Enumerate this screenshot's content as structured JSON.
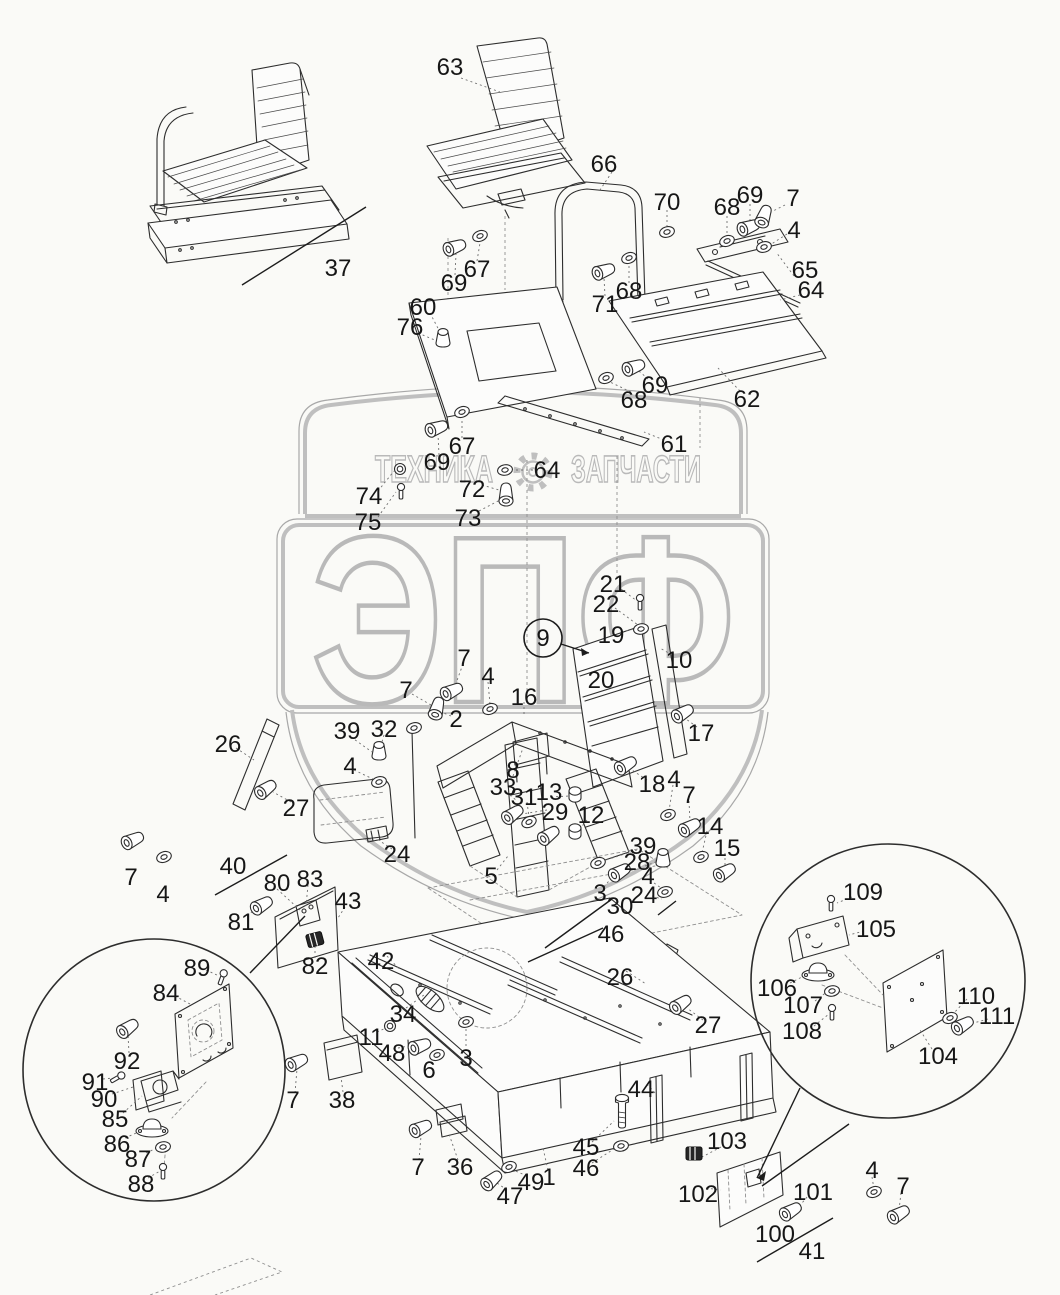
{
  "watermark": {
    "left": "ТЕХНИКА",
    "right": "ЗАПЧАСТИ",
    "big": "ЭПФ",
    "color": "#bfbfbf"
  },
  "colors": {
    "bg": "#fafaf7",
    "ink": "#2d2d2d",
    "label": "#161616",
    "watermark": "#bfbfbf"
  },
  "circled": {
    "t": "9",
    "x": 543,
    "y": 638,
    "r": 19,
    "sx": 561,
    "sy": 644,
    "ex": 589,
    "ey": 653
  },
  "labels": [
    [
      "63",
      450,
      67
    ],
    [
      "37",
      338,
      268
    ],
    [
      "66",
      604,
      164
    ],
    [
      "70",
      667,
      202
    ],
    [
      "68",
      727,
      207
    ],
    [
      "69",
      750,
      195
    ],
    [
      "7",
      793,
      198
    ],
    [
      "4",
      794,
      230
    ],
    [
      "65",
      805,
      270
    ],
    [
      "64",
      811,
      290
    ],
    [
      "71",
      605,
      304
    ],
    [
      "68",
      629,
      291
    ],
    [
      "60",
      423,
      307
    ],
    [
      "76",
      410,
      327
    ],
    [
      "67",
      477,
      269
    ],
    [
      "69",
      454,
      283
    ],
    [
      "69",
      655,
      385
    ],
    [
      "68",
      634,
      400
    ],
    [
      "62",
      747,
      399
    ],
    [
      "61",
      674,
      444
    ],
    [
      "67",
      462,
      446
    ],
    [
      "69",
      437,
      462
    ],
    [
      "64",
      547,
      470
    ],
    [
      "72",
      472,
      489
    ],
    [
      "73",
      468,
      518
    ],
    [
      "74",
      369,
      496
    ],
    [
      "75",
      368,
      522
    ],
    [
      "21",
      613,
      584
    ],
    [
      "22",
      606,
      604
    ],
    [
      "19",
      611,
      635
    ],
    [
      "10",
      679,
      660
    ],
    [
      "20",
      601,
      680
    ],
    [
      "7",
      464,
      658
    ],
    [
      "4",
      488,
      676
    ],
    [
      "7",
      406,
      690
    ],
    [
      "2",
      456,
      719
    ],
    [
      "16",
      524,
      697
    ],
    [
      "17",
      701,
      733
    ],
    [
      "26",
      228,
      744
    ],
    [
      "39",
      347,
      731
    ],
    [
      "32",
      384,
      729
    ],
    [
      "4",
      350,
      766
    ],
    [
      "27",
      296,
      808
    ],
    [
      "24",
      397,
      854
    ],
    [
      "8",
      513,
      770
    ],
    [
      "33",
      503,
      787
    ],
    [
      "31",
      524,
      797
    ],
    [
      "13",
      549,
      792
    ],
    [
      "29",
      555,
      812
    ],
    [
      "12",
      591,
      815
    ],
    [
      "18",
      652,
      784
    ],
    [
      "4",
      674,
      779
    ],
    [
      "7",
      689,
      795
    ],
    [
      "14",
      710,
      826
    ],
    [
      "15",
      727,
      848
    ],
    [
      "39",
      643,
      846
    ],
    [
      "28",
      637,
      862
    ],
    [
      "4",
      648,
      876
    ],
    [
      "24",
      644,
      895
    ],
    [
      "3",
      600,
      893
    ],
    [
      "30",
      620,
      906
    ],
    [
      "46",
      611,
      934
    ],
    [
      "5",
      491,
      876
    ],
    [
      "7",
      131,
      877
    ],
    [
      "4",
      163,
      894
    ],
    [
      "40",
      233,
      866
    ],
    [
      "80",
      277,
      883
    ],
    [
      "83",
      310,
      879
    ],
    [
      "81",
      241,
      922
    ],
    [
      "43",
      348,
      901
    ],
    [
      "82",
      315,
      966
    ],
    [
      "89",
      197,
      968
    ],
    [
      "84",
      166,
      993
    ],
    [
      "92",
      127,
      1061
    ],
    [
      "91",
      95,
      1082
    ],
    [
      "90",
      104,
      1099
    ],
    [
      "85",
      115,
      1119
    ],
    [
      "86",
      117,
      1144
    ],
    [
      "87",
      138,
      1159
    ],
    [
      "88",
      141,
      1184
    ],
    [
      "42",
      381,
      961
    ],
    [
      "34",
      403,
      1014
    ],
    [
      "11",
      371,
      1037
    ],
    [
      "48",
      392,
      1053
    ],
    [
      "6",
      429,
      1070
    ],
    [
      "3",
      466,
      1058
    ],
    [
      "7",
      293,
      1100
    ],
    [
      "38",
      342,
      1100
    ],
    [
      "7",
      418,
      1167
    ],
    [
      "36",
      460,
      1167
    ],
    [
      "47",
      510,
      1196
    ],
    [
      "49",
      531,
      1182
    ],
    [
      "1",
      549,
      1177
    ],
    [
      "45",
      586,
      1147
    ],
    [
      "46",
      586,
      1168
    ],
    [
      "44",
      641,
      1089
    ],
    [
      "26",
      620,
      977
    ],
    [
      "27",
      708,
      1025
    ],
    [
      "103",
      727,
      1141
    ],
    [
      "102",
      698,
      1194
    ],
    [
      "101",
      813,
      1192
    ],
    [
      "100",
      775,
      1234
    ],
    [
      "41",
      812,
      1251
    ],
    [
      "4",
      872,
      1170
    ],
    [
      "7",
      903,
      1186
    ],
    [
      "109",
      863,
      892
    ],
    [
      "105",
      876,
      929
    ],
    [
      "106",
      777,
      988
    ],
    [
      "107",
      803,
      1005
    ],
    [
      "108",
      802,
      1031
    ],
    [
      "104",
      938,
      1056
    ],
    [
      "110",
      976,
      996
    ],
    [
      "111",
      997,
      1016
    ]
  ],
  "leaders": {
    "solid": [
      [
        366,
        207,
        242,
        285
      ],
      [
        215,
        895,
        287,
        855
      ],
      [
        757,
        1262,
        833,
        1218
      ],
      [
        612,
        899,
        545,
        948
      ],
      [
        603,
        928,
        528,
        962
      ],
      [
        305,
        916,
        250,
        973
      ],
      [
        800,
        1088,
        757,
        1178
      ],
      [
        849,
        1124,
        762,
        1186
      ],
      [
        658,
        915,
        676,
        901
      ]
    ],
    "dotted": [
      [
        461,
        78,
        500,
        92
      ],
      [
        612,
        172,
        600,
        190
      ],
      [
        667,
        210,
        667,
        226
      ],
      [
        727,
        216,
        727,
        235
      ],
      [
        750,
        204,
        750,
        221
      ],
      [
        785,
        205,
        769,
        213
      ],
      [
        787,
        234,
        770,
        245
      ],
      [
        794,
        276,
        776,
        252
      ],
      [
        800,
        295,
        780,
        300
      ],
      [
        605,
        296,
        604,
        278
      ],
      [
        629,
        283,
        629,
        264
      ],
      [
        430,
        313,
        441,
        334
      ],
      [
        418,
        333,
        437,
        341
      ],
      [
        477,
        261,
        480,
        243
      ],
      [
        455,
        275,
        456,
        254
      ],
      [
        648,
        379,
        639,
        371
      ],
      [
        631,
        392,
        610,
        382
      ],
      [
        740,
        391,
        718,
        368
      ],
      [
        664,
        440,
        644,
        432
      ],
      [
        462,
        438,
        462,
        418
      ],
      [
        439,
        455,
        438,
        434
      ],
      [
        538,
        470,
        513,
        470
      ],
      [
        482,
        485,
        499,
        490
      ],
      [
        479,
        511,
        500,
        500
      ],
      [
        378,
        491,
        394,
        471
      ],
      [
        378,
        517,
        396,
        492
      ],
      [
        621,
        589,
        637,
        601
      ],
      [
        615,
        608,
        638,
        625
      ],
      [
        621,
        632,
        634,
        629
      ],
      [
        672,
        655,
        660,
        648
      ],
      [
        697,
        727,
        686,
        719
      ],
      [
        524,
        702,
        524,
        714
      ],
      [
        463,
        664,
        455,
        686
      ],
      [
        488,
        682,
        490,
        704
      ],
      [
        412,
        694,
        431,
        705
      ],
      [
        451,
        716,
        441,
        712
      ],
      [
        647,
        780,
        632,
        770
      ],
      [
        673,
        785,
        669,
        811
      ],
      [
        689,
        801,
        690,
        822
      ],
      [
        707,
        831,
        702,
        853
      ],
      [
        725,
        853,
        725,
        867
      ],
      [
        637,
        850,
        603,
        861
      ],
      [
        645,
        866,
        658,
        861
      ],
      [
        650,
        880,
        661,
        888
      ],
      [
        652,
        896,
        662,
        899
      ],
      [
        604,
        887,
        617,
        871
      ],
      [
        497,
        870,
        508,
        856
      ],
      [
        513,
        776,
        523,
        748
      ],
      [
        506,
        792,
        516,
        800
      ],
      [
        527,
        802,
        529,
        817
      ],
      [
        551,
        797,
        570,
        796
      ],
      [
        547,
        810,
        522,
        814
      ],
      [
        587,
        820,
        578,
        831
      ],
      [
        236,
        748,
        254,
        760
      ],
      [
        351,
        737,
        372,
        752
      ],
      [
        384,
        735,
        380,
        749
      ],
      [
        354,
        770,
        375,
        780
      ],
      [
        291,
        802,
        273,
        792
      ],
      [
        392,
        849,
        377,
        839
      ],
      [
        277,
        889,
        300,
        910
      ],
      [
        308,
        885,
        306,
        906
      ],
      [
        247,
        916,
        258,
        907
      ],
      [
        345,
        907,
        338,
        918
      ],
      [
        315,
        958,
        315,
        947
      ],
      [
        206,
        970,
        219,
        976
      ],
      [
        175,
        996,
        190,
        1004
      ],
      [
        129,
        1053,
        128,
        1035
      ],
      [
        103,
        1079,
        113,
        1078
      ],
      [
        112,
        1094,
        133,
        1087
      ],
      [
        123,
        1113,
        142,
        1096
      ],
      [
        125,
        1138,
        143,
        1130
      ],
      [
        146,
        1153,
        159,
        1147
      ],
      [
        148,
        1178,
        160,
        1171
      ],
      [
        387,
        956,
        400,
        970
      ],
      [
        406,
        1008,
        424,
        995
      ],
      [
        377,
        1032,
        388,
        1027
      ],
      [
        398,
        1048,
        414,
        1045
      ],
      [
        431,
        1064,
        436,
        1057
      ],
      [
        466,
        1051,
        466,
        1028
      ],
      [
        295,
        1093,
        297,
        1069
      ],
      [
        343,
        1092,
        341,
        1077
      ],
      [
        419,
        1160,
        421,
        1136
      ],
      [
        458,
        1160,
        449,
        1134
      ],
      [
        507,
        1190,
        497,
        1183
      ],
      [
        527,
        1176,
        511,
        1169
      ],
      [
        548,
        1170,
        543,
        1148
      ],
      [
        592,
        1142,
        614,
        1121
      ],
      [
        592,
        1163,
        617,
        1147
      ],
      [
        647,
        1084,
        655,
        1093
      ],
      [
        626,
        971,
        646,
        984
      ],
      [
        703,
        1020,
        687,
        1008
      ],
      [
        721,
        1147,
        702,
        1157
      ],
      [
        706,
        1188,
        721,
        1190
      ],
      [
        807,
        1197,
        797,
        1209
      ],
      [
        872,
        1177,
        874,
        1189
      ],
      [
        901,
        1193,
        899,
        1210
      ],
      [
        852,
        897,
        837,
        903
      ],
      [
        864,
        931,
        849,
        935
      ],
      [
        790,
        983,
        806,
        975
      ],
      [
        815,
        1001,
        828,
        991
      ],
      [
        814,
        1026,
        829,
        1014
      ],
      [
        932,
        1049,
        920,
        1030
      ],
      [
        967,
        999,
        953,
        1014
      ],
      [
        988,
        1019,
        970,
        1024
      ]
    ]
  },
  "hardware": [
    [
      "bolt",
      455,
      247,
      -20
    ],
    [
      "washer",
      480,
      236,
      -20
    ],
    [
      "bolt",
      604,
      271,
      -20
    ],
    [
      "washer",
      629,
      258,
      -20
    ],
    [
      "washer",
      667,
      232,
      -15
    ],
    [
      "washer",
      727,
      241,
      -20
    ],
    [
      "bolt",
      749,
      227,
      -20
    ],
    [
      "bolt",
      764,
      216,
      -70
    ],
    [
      "washer",
      764,
      247,
      -15
    ],
    [
      "knob",
      443,
      340,
      0
    ],
    [
      "bolt",
      437,
      428,
      -20
    ],
    [
      "washer",
      462,
      412,
      -20
    ],
    [
      "bolt",
      634,
      367,
      -20
    ],
    [
      "washer",
      606,
      378,
      -20
    ],
    [
      "washer",
      505,
      470,
      -10
    ],
    [
      "bolt",
      506,
      494,
      -90
    ],
    [
      "ring",
      400,
      469,
      0
    ],
    [
      "pin",
      401,
      492,
      0
    ],
    [
      "pin",
      640,
      603,
      0
    ],
    [
      "washer",
      641,
      629,
      -10
    ],
    [
      "bolt",
      452,
      691,
      -25
    ],
    [
      "washer",
      490,
      709,
      -20
    ],
    [
      "bolt",
      437,
      708,
      -75
    ],
    [
      "washer",
      414,
      728,
      -15
    ],
    [
      "bolt",
      683,
      713,
      -30
    ],
    [
      "bolt",
      626,
      765,
      -30
    ],
    [
      "washer",
      668,
      815,
      -20
    ],
    [
      "bolt",
      690,
      827,
      -30
    ],
    [
      "washer",
      701,
      857,
      -20
    ],
    [
      "bolt",
      725,
      872,
      -30
    ],
    [
      "bolt",
      513,
      814,
      -35
    ],
    [
      "washer",
      529,
      822,
      -25
    ],
    [
      "bolt",
      549,
      835,
      -35
    ],
    [
      "bushing",
      575,
      795,
      0
    ],
    [
      "bushing",
      575,
      832,
      0
    ],
    [
      "washer",
      598,
      863,
      -20
    ],
    [
      "bolt",
      620,
      872,
      -30
    ],
    [
      "knob",
      663,
      860,
      0
    ],
    [
      "washer",
      665,
      892,
      -15
    ],
    [
      "knob",
      379,
      753,
      0
    ],
    [
      "washer",
      379,
      782,
      -15
    ],
    [
      "bolt",
      266,
      789,
      -35
    ],
    [
      "bolt",
      133,
      840,
      -25
    ],
    [
      "washer",
      164,
      857,
      -20
    ],
    [
      "bolt",
      262,
      905,
      -30
    ],
    [
      "bolt",
      681,
      1004,
      -35
    ],
    [
      "bolt",
      297,
      1062,
      -25
    ],
    [
      "bolt",
      421,
      1128,
      -25
    ],
    [
      "bolt",
      492,
      1180,
      -40
    ],
    [
      "washer",
      509,
      1167,
      -20
    ],
    [
      "vbolt",
      622,
      1112,
      0
    ],
    [
      "washer",
      621,
      1146,
      -10
    ],
    [
      "ring",
      390,
      1026,
      0
    ],
    [
      "bolt",
      420,
      1046,
      -20
    ],
    [
      "washer",
      437,
      1055,
      -20
    ],
    [
      "washer",
      466,
      1022,
      -15
    ],
    [
      "conn",
      315,
      940,
      -15
    ],
    [
      "conn",
      694,
      1154,
      0
    ],
    [
      "bolt",
      791,
      1211,
      -30
    ],
    [
      "washer",
      874,
      1192,
      -20
    ],
    [
      "bolt",
      899,
      1214,
      -30
    ],
    [
      "pin",
      222,
      978,
      20
    ],
    [
      "bolt",
      128,
      1028,
      -35
    ],
    [
      "pin",
      117,
      1078,
      60
    ],
    [
      "mount",
      152,
      1128,
      0
    ],
    [
      "washer",
      163,
      1147,
      -10
    ],
    [
      "pin",
      163,
      1172,
      0
    ],
    [
      "pin",
      831,
      904,
      0
    ],
    [
      "mount",
      818,
      972,
      0
    ],
    [
      "washer",
      832,
      991,
      -10
    ],
    [
      "pin",
      832,
      1013,
      0
    ],
    [
      "washer",
      950,
      1018,
      -20
    ],
    [
      "bolt",
      963,
      1025,
      -30
    ]
  ]
}
